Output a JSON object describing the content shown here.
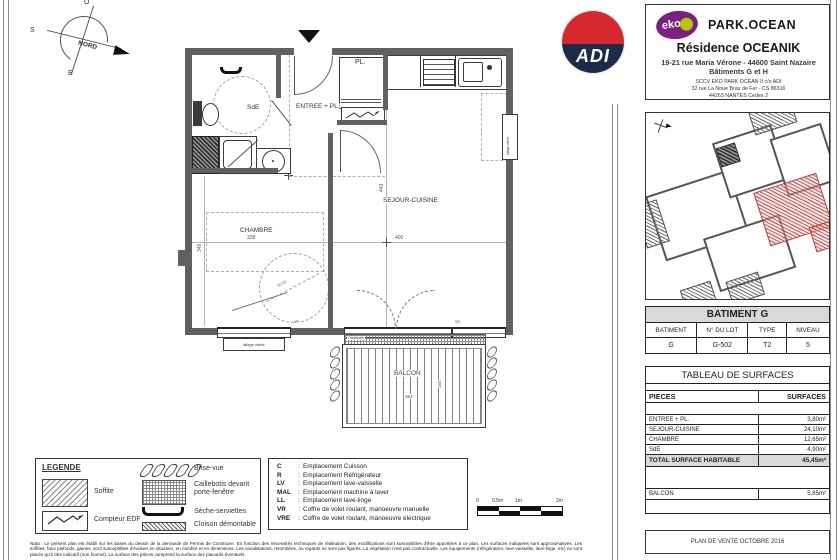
{
  "titleblock": {
    "adi": "ADI",
    "eko": "eko",
    "brand": "PARK.OCEAN",
    "residence": "Résidence OCEANIK",
    "address1": "19-21 rue Maria Vérone - 44600 Saint Nazaire",
    "address2": "Bâtiments G et H",
    "sccv1": "SCCV EKO PARK OCEAN II c/o ADI",
    "sccv2": "32 rue La Noue Bras de Fer - CS 86316",
    "sccv3": "44263 NANTES Cedex 2",
    "plan_ref": "PLAN DE VENTE OCTOBRE 2016"
  },
  "compass": {
    "west": "O",
    "south": "S",
    "east": "E",
    "north": "NORD"
  },
  "plan": {
    "rooms": {
      "sde": "SdE",
      "entree": "ENTREE + PL.",
      "placard": "PL.",
      "chambre": "CHAMBRE",
      "sejour": "SEJOUR-CUISINE",
      "balcon": "BALCON"
    },
    "tags": {
      "allege": "allège vitrée",
      "vr": "VR",
      "caillebotis": "Caillebotis",
      "cuisson": "C",
      "diametre": "Ø150"
    },
    "dims": {
      "sejour_w": "400",
      "chambre_w": "328",
      "sejour_h": "443",
      "chambre_h": "349",
      "balcon_w": "364",
      "balcon_h": "160"
    }
  },
  "lot_table": {
    "title": "BATIMENT G",
    "headers": [
      "BATIMENT",
      "N° DU LOT",
      "TYPE",
      "NIVEAU"
    ],
    "row": [
      "G",
      "G-502",
      "T2",
      "5"
    ]
  },
  "surface_table": {
    "title": "TABLEAU DE SURFACES",
    "headers": [
      "PIECES",
      "SURFACES"
    ],
    "rows": [
      {
        "piece": "ENTREE + PL.",
        "surface": "3,80m²"
      },
      {
        "piece": "SEJOUR-CUISINE",
        "surface": "24,10m²"
      },
      {
        "piece": "CHAMBRE",
        "surface": "12,65m²"
      },
      {
        "piece": "SdE",
        "surface": "4,90m²"
      }
    ],
    "total_label": "TOTAL SURFACE HABITABLE",
    "total_value": "45,45m²",
    "balcon_label": "BALCON",
    "balcon_value": "5,85m²"
  },
  "legend": {
    "title": "LEGENDE",
    "soffite": "Soffite",
    "compteur": "Compteur EDF",
    "brise_vue": "Brise-vue",
    "caillebotis": "Caillebotis devant porte-fenêtre",
    "seche": "Sèche-serviettes",
    "cloison": "Cloison démontable"
  },
  "abbreviations": [
    {
      "key": "C",
      "label": "Emplacement Cuisson"
    },
    {
      "key": "R",
      "label": "Emplacement Réfrigérateur"
    },
    {
      "key": "LV",
      "label": "Emplacement lave-vaisselle"
    },
    {
      "key": "MAL",
      "label": "Emplacement machine à laver"
    },
    {
      "key": "LL",
      "label": "Emplacement lave-linge"
    },
    {
      "key": "VR",
      "label": "Coffre de volet roulant, manoeuvre manuelle"
    },
    {
      "key": "VRE",
      "label": "Coffre de volet roulant, manoeuvre électrique"
    }
  ],
  "scale_bar": {
    "labels": [
      "0",
      "0.5m",
      "1m",
      "2m"
    ]
  },
  "note": "Nota : Le présent plan est établi sur les bases du dessin de la demande de Permis de Construire. En fonction des nécessités techniques de réalisation, des modifications sont susceptibles d'être apportées à ce plan. Les surfaces indiquées sont approximatives. Les soffites, faux plafonds, gaines, sont susceptibles d'évoluer en situation, en nombre et en dimensions. Les canalisations, retombées, ou regards ne sont pas figurés. La végétation n'est pas contractuelle. Les équipements (réfrigérateur, lave-vaisselle, lave-linge, etc) ne sont placés qu'à titre indicatif (non fournis). La surface des pièces comprend la surface des placards éventuels.",
  "colors": {
    "adi_red": "#d7282f",
    "adi_navy": "#1c2b4a",
    "eko_purple": "#7b2082",
    "eko_green": "#b5c900",
    "unit_red": "#b23a32",
    "wall_gray": "#616161",
    "table_header_bg": "#d9d9d9"
  }
}
